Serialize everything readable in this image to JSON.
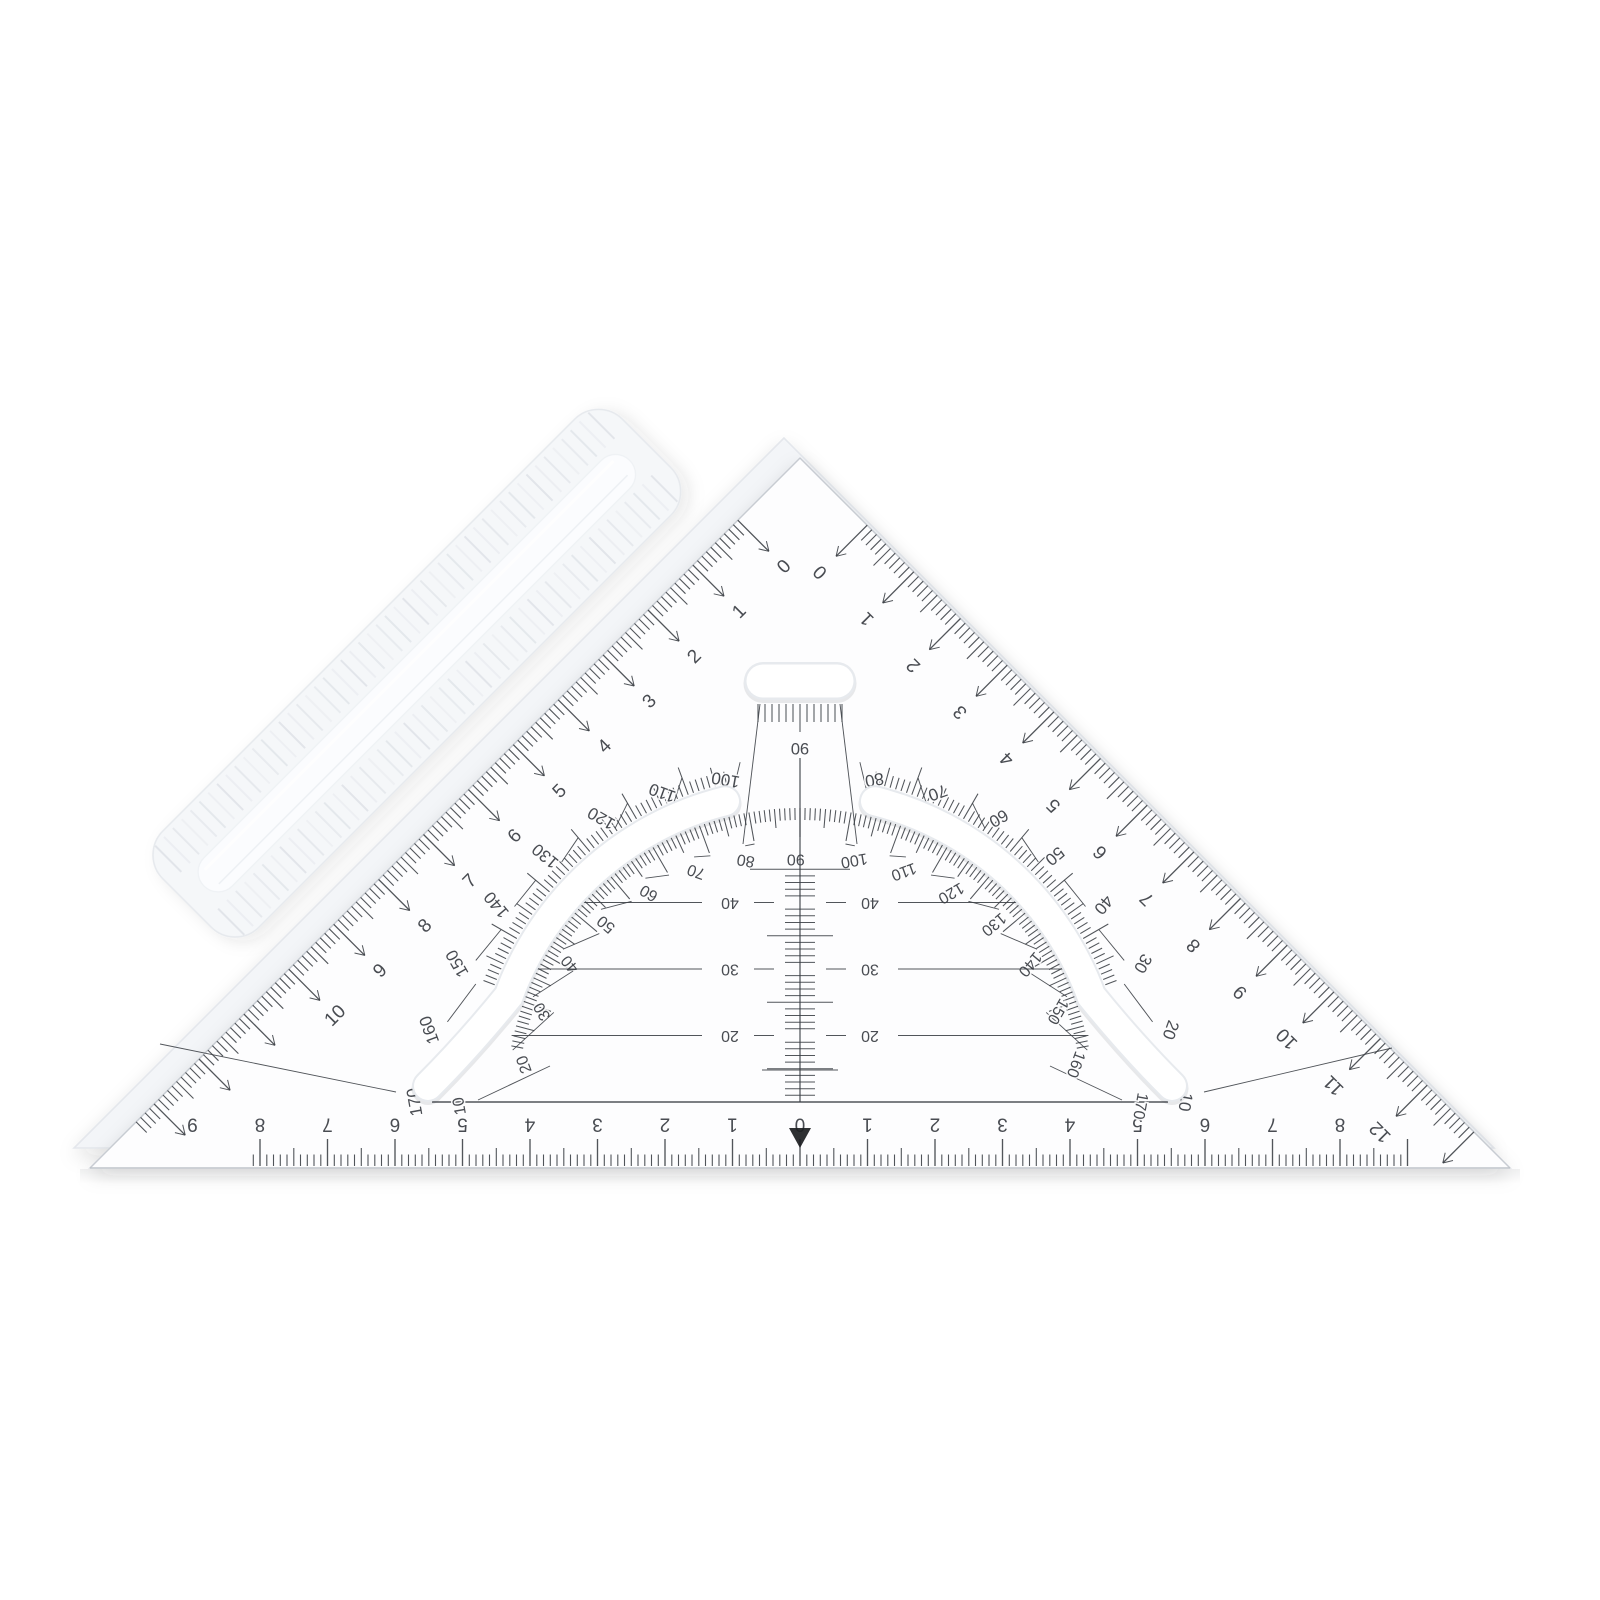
{
  "scene": {
    "title": "Transparent 45-degree set square with protractor, parallel guide lines and frosted grip bar on white background"
  },
  "colors": {
    "background": "#ffffff",
    "ink": "#3a3e44",
    "body": "#fdfdfe",
    "body_edge": "#dadde2",
    "bevel": "#b9bec5",
    "backing": "#f3f5f8",
    "backing_edge": "#e4e7ec",
    "frost": "#f5f7f9",
    "frost_edge": "#e6e9ed",
    "frost_rib": "#dfe3e8",
    "spine": "#fbfcfe",
    "slot_border": "#e7eaee",
    "slot_shadow": "rgba(40,50,60,0.10)"
  },
  "left_edge_scale": {
    "unit_labels": [
      "0",
      "1",
      "2",
      "3",
      "4",
      "5",
      "6",
      "7",
      "8",
      "9",
      "10"
    ]
  },
  "right_edge_scale": {
    "unit_labels": [
      "0",
      "1",
      "2",
      "3",
      "4",
      "5",
      "6",
      "7",
      "8",
      "9",
      "10",
      "11",
      "12"
    ]
  },
  "bottom_scale": {
    "center_label": "0",
    "left_labels": [
      "1",
      "2",
      "3",
      "4",
      "5",
      "6",
      "7",
      "8",
      "9"
    ],
    "right_labels": [
      "1",
      "2",
      "3",
      "4",
      "5",
      "6",
      "7",
      "8"
    ],
    "pointer_marker": "filled-triangle-down"
  },
  "protractor": {
    "outer_labels": [
      "10",
      "20",
      "30",
      "40",
      "50",
      "60",
      "70",
      "80",
      "100",
      "110",
      "120",
      "130",
      "140",
      "150",
      "160",
      "170"
    ],
    "inner_labels": [
      "170",
      "160",
      "150",
      "140",
      "130",
      "120",
      "110",
      "100",
      "90",
      "80",
      "70",
      "60",
      "50",
      "40",
      "30",
      "20",
      "10"
    ],
    "apex_fan_label": "90",
    "inner_apex_label": "90",
    "guide_lines": [
      {
        "label": "40"
      },
      {
        "label": "30"
      },
      {
        "label": "20"
      }
    ]
  }
}
